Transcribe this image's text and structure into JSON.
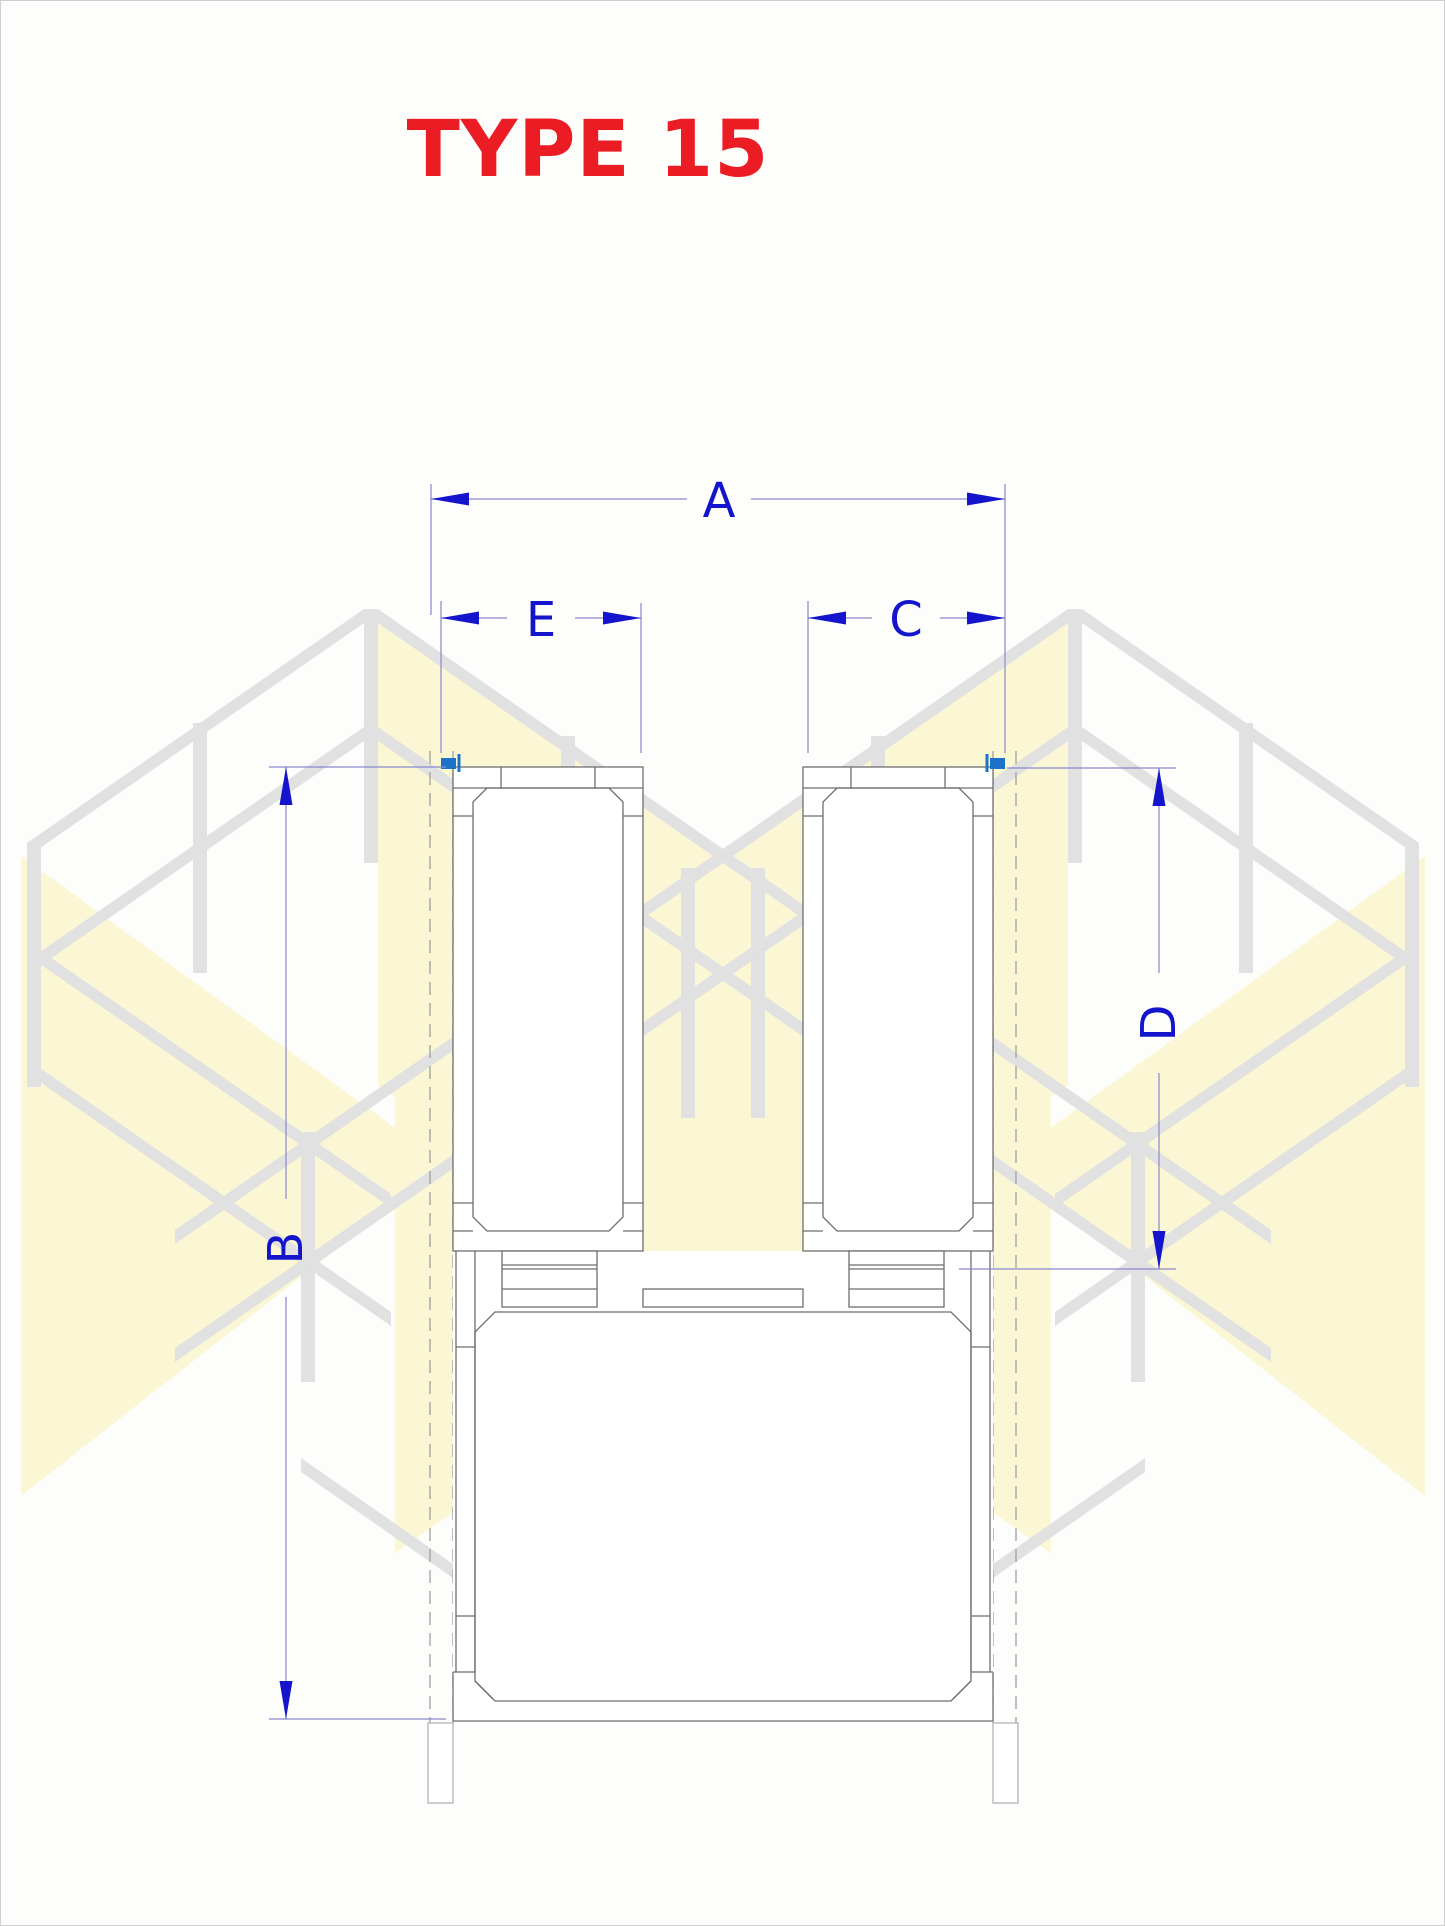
{
  "title": "TYPE 15",
  "dimension_labels": {
    "a": "A",
    "b": "B",
    "c": "C",
    "d": "D",
    "e": "E"
  },
  "colors": {
    "title_red": "#EC1C24",
    "dimension_blue": "#1414CC",
    "extension_line_blue": "#8888CC",
    "drawing_line_gray": "#6E6E6E",
    "hidden_line_gray": "#A0A0A0",
    "iso_frame_gray": "#E1E1E1",
    "iso_face_yellow": "#FBF7D5",
    "pivot_marker_blue": "#1B74C9",
    "background": "#FDFDFB"
  },
  "icons": {
    "left_pivot_marker": "hinge-pivot-icon",
    "right_pivot_marker": "hinge-pivot-icon"
  },
  "drawing": {
    "view": "front elevation of double-leaf gate unit",
    "labeled_dimensions": [
      "A",
      "B",
      "C",
      "D",
      "E"
    ]
  }
}
